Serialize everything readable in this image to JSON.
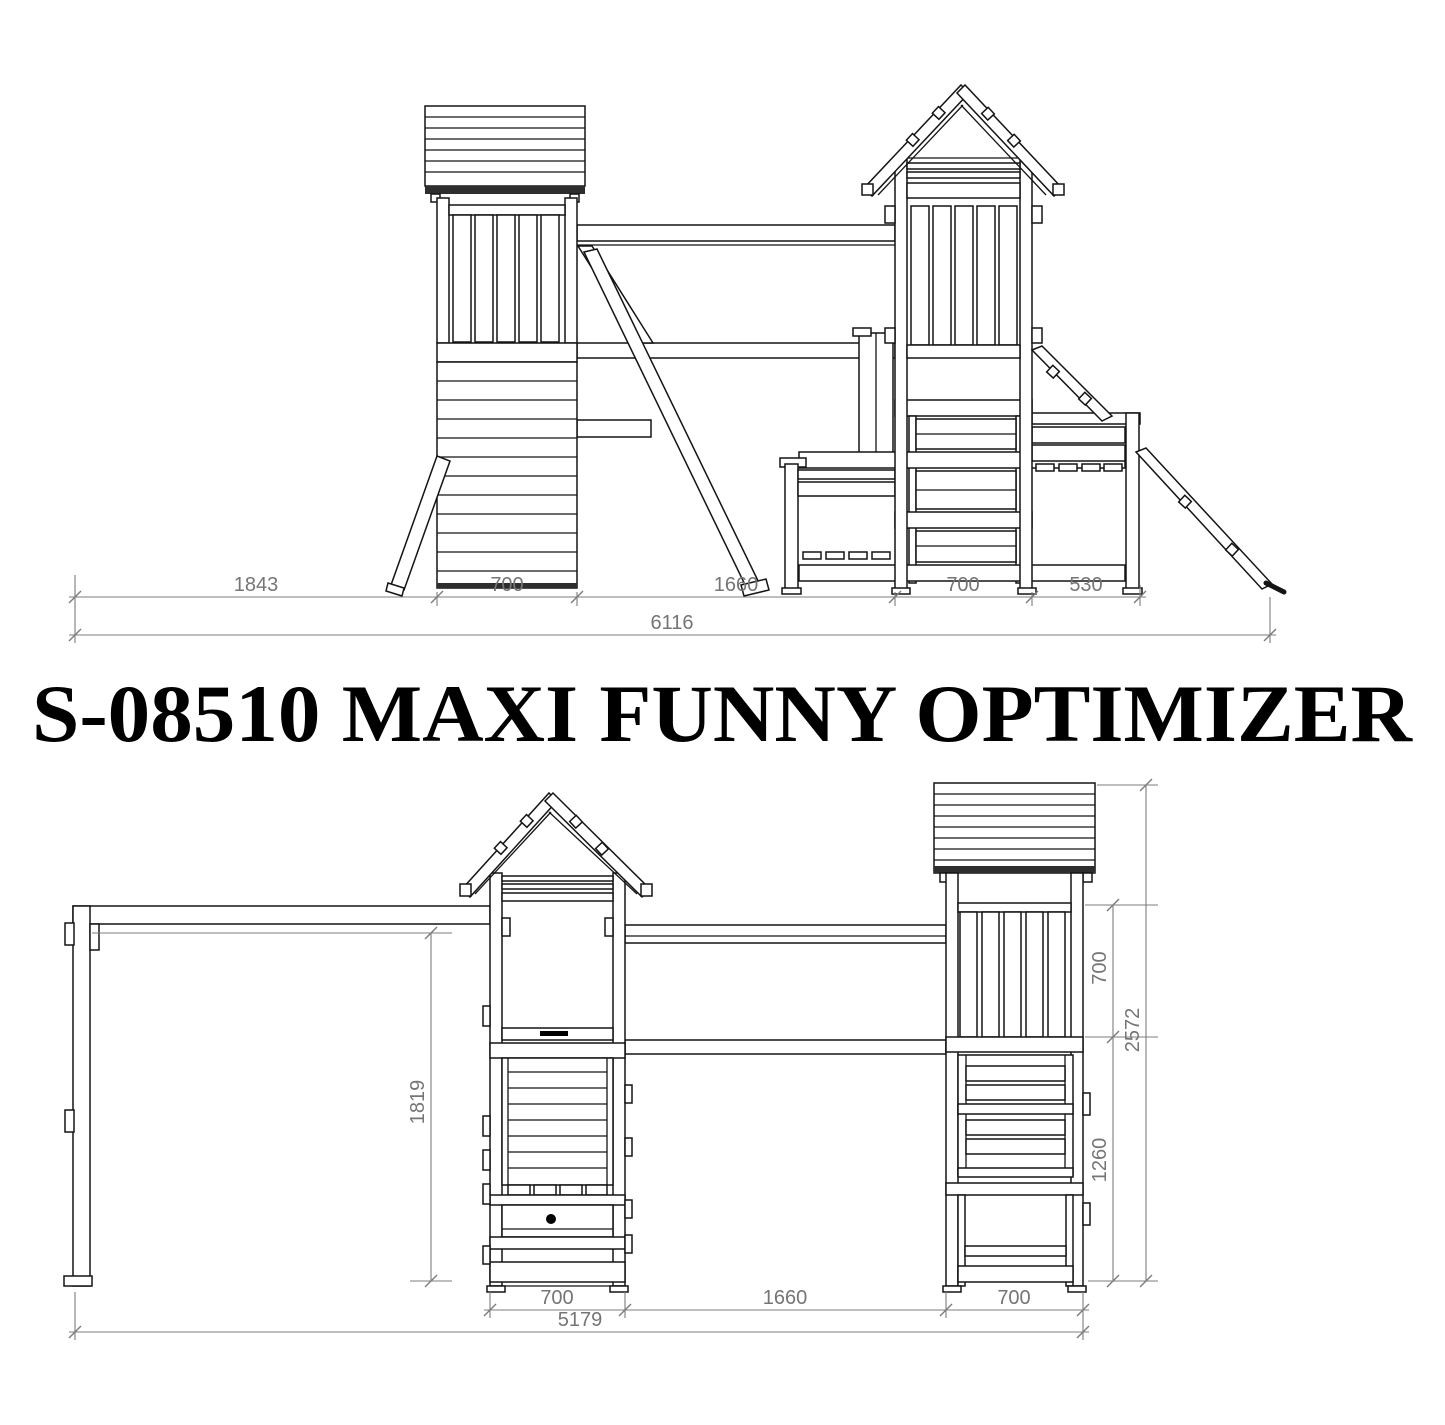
{
  "title": "S-08510 MAXI FUNNY OPTIMIZER",
  "colors": {
    "structure_line": "#141414",
    "dimension_line": "#7c7c7c",
    "dimension_text": "#757575",
    "background": "#ffffff"
  },
  "top_view": {
    "dim_segments": [
      "1843",
      "700",
      "1660",
      "700",
      "530"
    ],
    "dim_overall": "6116"
  },
  "bottom_view": {
    "dim_bottom_segments": [
      "700",
      "1660",
      "700"
    ],
    "dim_bottom_overall": "5179",
    "dim_height_ladder": "1819",
    "dim_height_railing": "700",
    "dim_height_lower": "1260",
    "dim_height_overall": "2572"
  }
}
